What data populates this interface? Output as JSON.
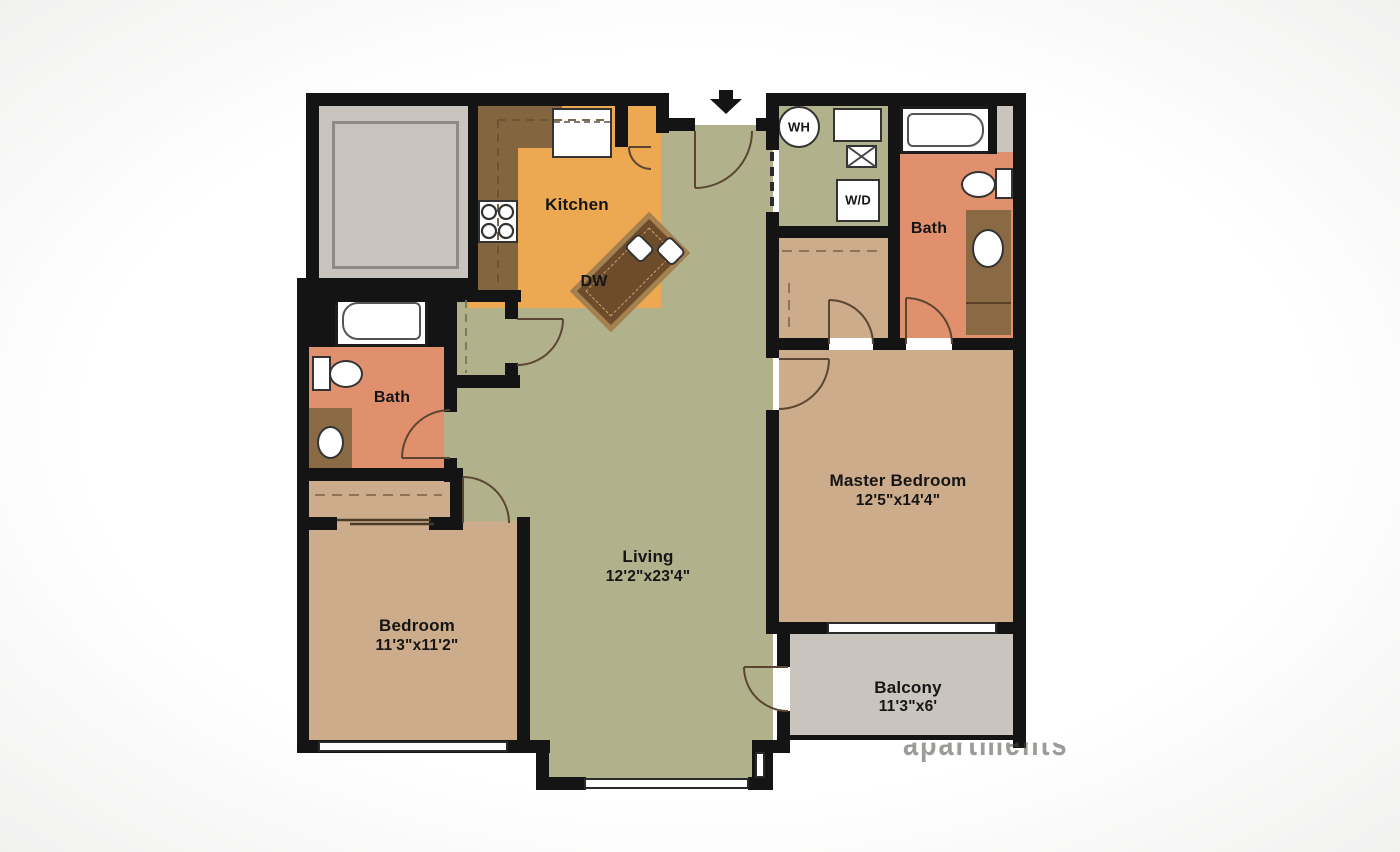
{
  "rooms": {
    "kitchen": {
      "label": "Kitchen"
    },
    "living": {
      "label": "Living",
      "dims": "12'2\"x23'4\""
    },
    "bedroom": {
      "label": "Bedroom",
      "dims": "11'3\"x11'2\""
    },
    "master_bedroom": {
      "label": "Master Bedroom",
      "dims": "12'5\"x14'4\""
    },
    "balcony": {
      "label": "Balcony",
      "dims": "11'3\"x6'"
    },
    "bath_main": {
      "label": "Bath"
    },
    "bath_master": {
      "label": "Bath"
    }
  },
  "fixtures": {
    "dishwasher_island": {
      "label": "DW"
    },
    "water_heater": {
      "label": "WH"
    },
    "washer_dryer": {
      "label": "W/D"
    }
  },
  "watermark": "apartments",
  "colors": {
    "wall": "#141414",
    "floor_living": "#b1b28b",
    "floor_kitchen": "#eca952",
    "floor_bath": "#e0906c",
    "floor_bedroom": "#cdac8b",
    "floor_balcony": "#c9c5be",
    "counter": "#83653f",
    "island": "#6d4c2c",
    "island_edge": "#a5814f",
    "vanity": "#8a6a45",
    "line": "#5a4632"
  }
}
